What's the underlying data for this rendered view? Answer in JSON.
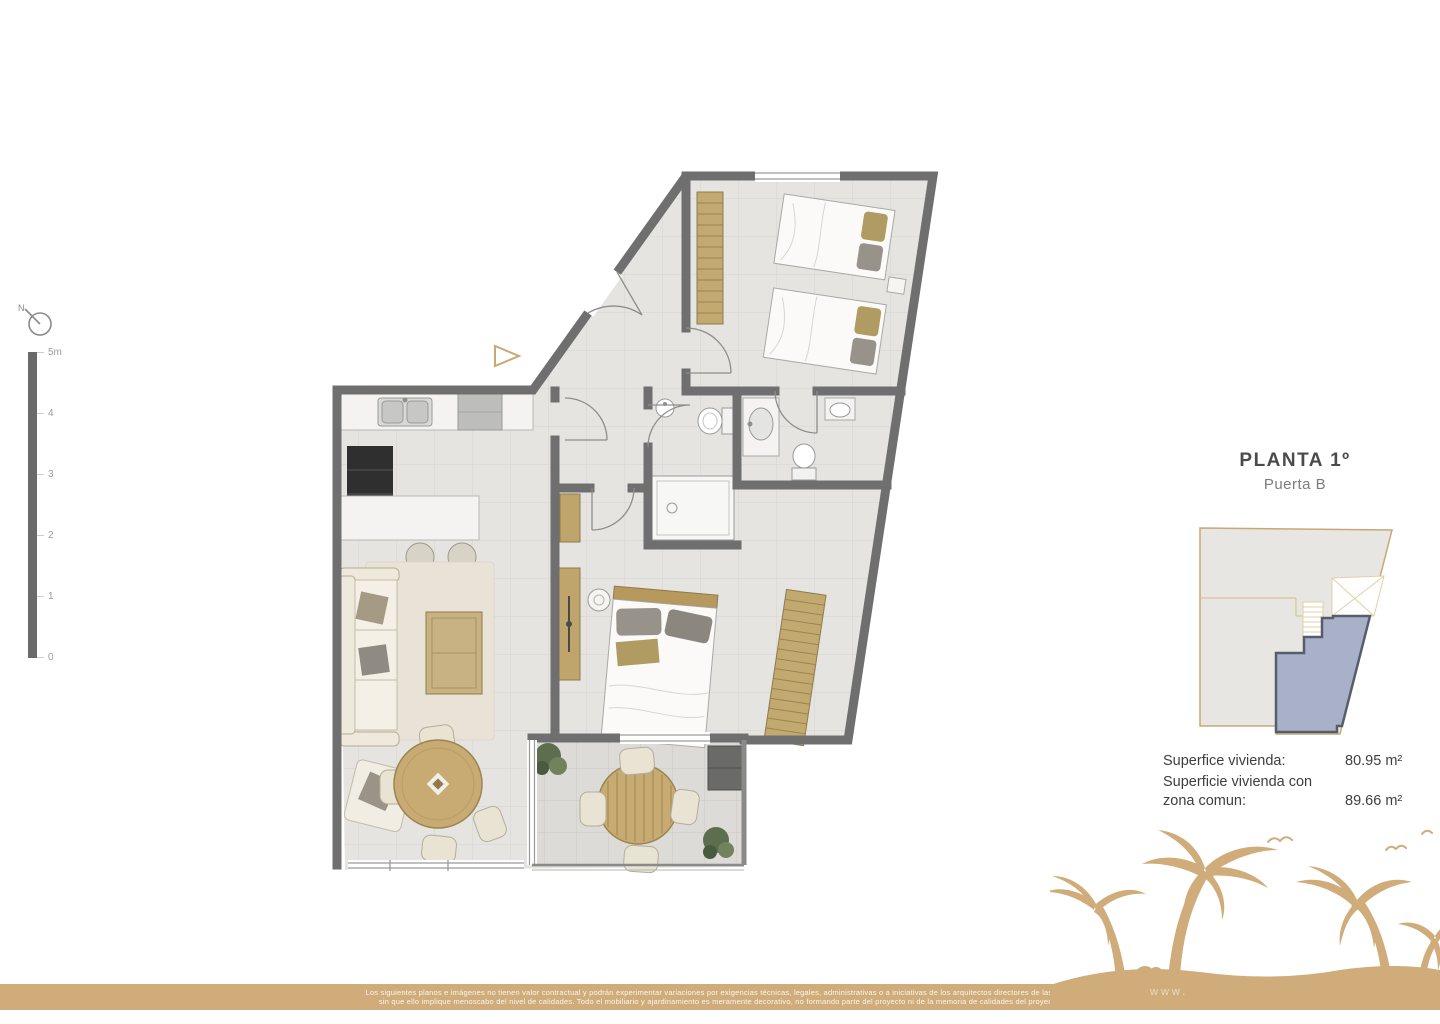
{
  "compass": {
    "label": "N"
  },
  "scale_bar": {
    "labels": [
      "5m",
      "4",
      "3",
      "2",
      "1",
      "0"
    ]
  },
  "panel": {
    "title": "PLANTA 1º",
    "subtitle": "Puerta B",
    "minimap": {
      "highlight_color": "#a9b1c8",
      "building_outline_color": "#c9a873"
    },
    "surface": {
      "rows": [
        {
          "label": "Superfice vivienda:",
          "value": "80.95 m²"
        },
        {
          "label": "Superficie vivienda con zona comun:",
          "value": "89.66 m²"
        }
      ]
    }
  },
  "plan": {
    "colors": {
      "wall": "#6f6f6f",
      "floor": "#e5e4e1",
      "terrace_floor": "#dcdbd8",
      "wood": "#c2a96f",
      "fabric": "#efe9dc",
      "plant": "#5d6e4e",
      "accent_tan": "#c8a873"
    }
  },
  "footer": {
    "band_color": "#d0ac7b",
    "disclaimer_line1": "Los siguientes planos e imágenes no tienen valor contractual y podrán experimentar variaciones por exigencias técnicas, legales, administrativas o a iniciativas de los arquitectos directores de las obras",
    "disclaimer_line2": "sin que ello implique menoscabo del nivel de calidades. Todo el mobiliario y ajardinamiento es meramente decorativo, no formando parte del proyecto ni de la memoria de calidades del proyecto.",
    "watermark": "www."
  }
}
